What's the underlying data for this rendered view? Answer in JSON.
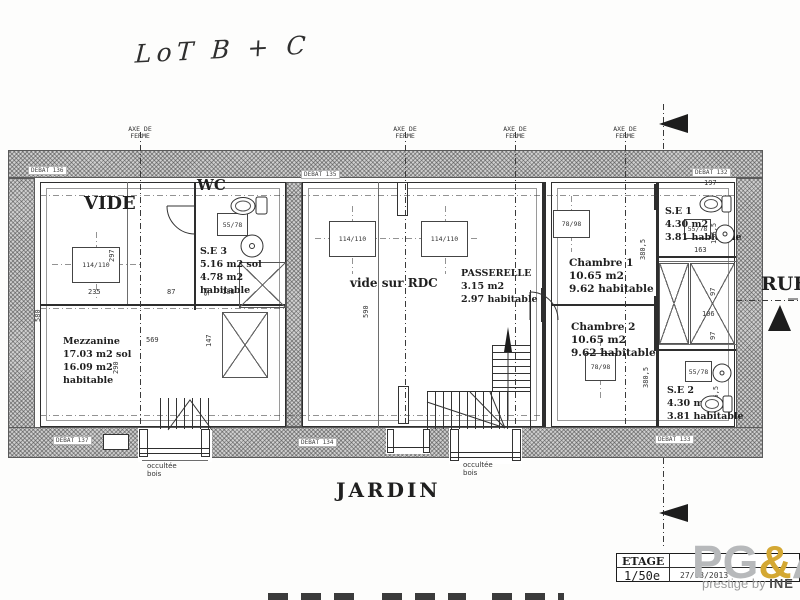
{
  "colors": {
    "ink": "#2e2e2e",
    "wall_gray": "#cfcfcf",
    "logo_gray": "#b7b9bb",
    "logo_gold": "#d4a833"
  },
  "handwriting": {
    "lot_label": "LoT B + C"
  },
  "axes": {
    "line1": "AXE DE",
    "line2": "FERME"
  },
  "wall_tags": {
    "top_left": "DEBAT 136",
    "top_center": "DEBAT 135",
    "top_right": "DEBAT 132",
    "bottom_left": "DEBAT 137",
    "bottom_center": "DEBAT 134",
    "bottom_right": "DEBAT 133"
  },
  "rooms": {
    "vide": {
      "name": "VIDE"
    },
    "wc": {
      "name": "WC"
    },
    "se3": {
      "name": "S.E 3",
      "l2": "5.16 m2 sol",
      "l3": "4.78 m2",
      "l4": "habitable"
    },
    "mezzanine": {
      "name": "Mezzanine",
      "l2": "17.03 m2 sol",
      "l3": "16.09 m2",
      "l4": "habitable"
    },
    "vide_rdc": {
      "name": "vide sur RDC"
    },
    "passerelle": {
      "name": "PASSERELLE",
      "l2": "3.15 m2",
      "l3": "2.97 habitable"
    },
    "chambre1": {
      "name": "Chambre 1",
      "l2": "10.65 m2",
      "l3": "9.62 habitable"
    },
    "chambre2": {
      "name": "Chambre 2",
      "l2": "10.65 m2",
      "l3": "9.62 habitable"
    },
    "se1": {
      "name": "S.E 1",
      "l2": "4.30 m2",
      "l3": "3.81 habitable"
    },
    "se2": {
      "name": "S.E 2",
      "l2": "4.30 m2",
      "l3": "3.81 habitable"
    }
  },
  "skylights": {
    "large": "114/110",
    "medium": "78/98",
    "small": "55/78"
  },
  "dims": {
    "w297": "297",
    "w235": "235",
    "w87": "87",
    "w90": "90",
    "w180": "180",
    "h580": "580",
    "w569": "569",
    "h290": "290",
    "h147": "147",
    "h590": "590",
    "h380": "380,5",
    "h196": "196,5",
    "w163": "163",
    "w97": "97",
    "w106": "106",
    "w197": "197"
  },
  "exterior": {
    "jardin": "JARDIN",
    "rue": "RUE"
  },
  "window_note": {
    "l1": "occultée",
    "l2": "bois"
  },
  "titleblock": {
    "stage": "ETAGE",
    "scale": "1/50e",
    "date": "27/03/2013"
  },
  "logo": {
    "pg": "PG",
    "amp": "&",
    "a": "A",
    "tagline": "prestige by",
    "brand": "INE"
  }
}
